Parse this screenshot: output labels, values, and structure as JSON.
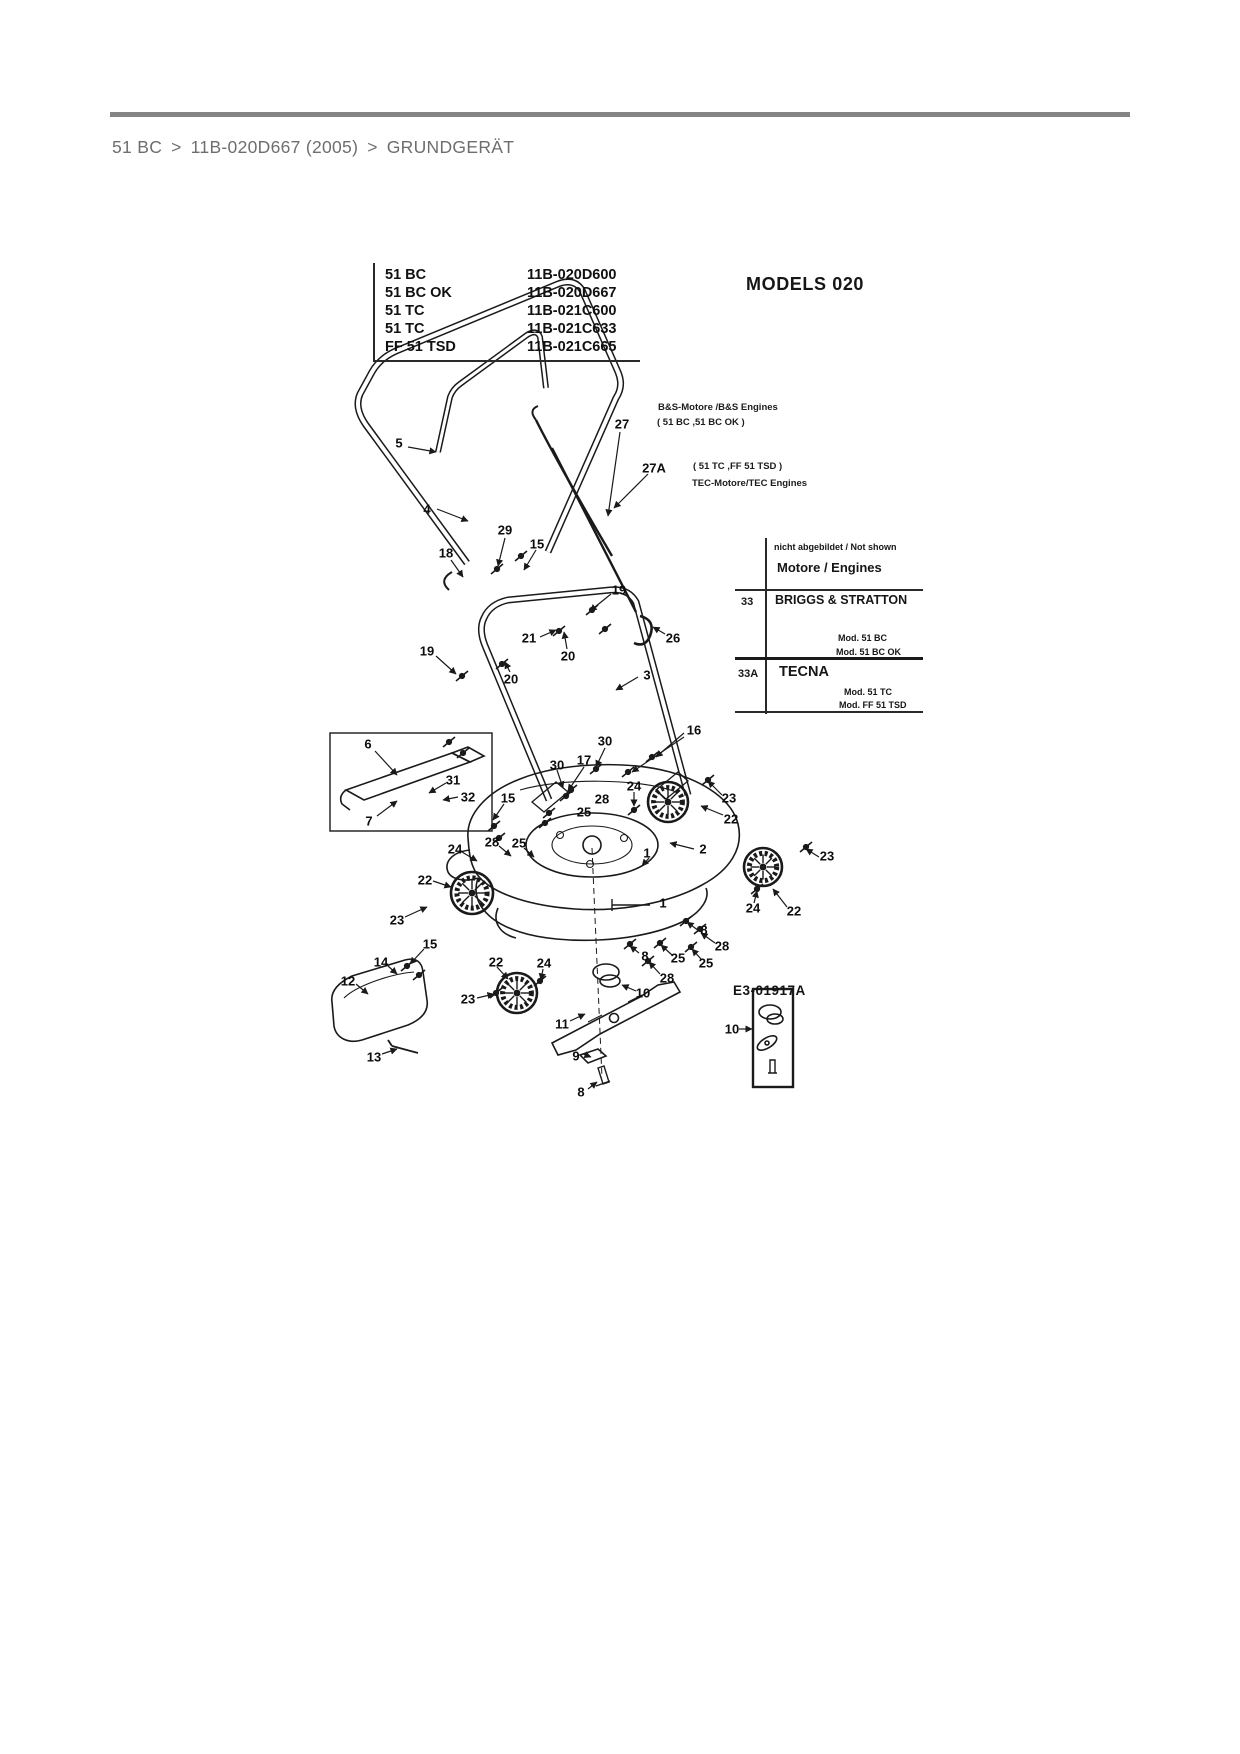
{
  "breadcrumb": {
    "separator": ">",
    "items": [
      {
        "label": "51 BC"
      },
      {
        "label": "11B-020D667 (2005)"
      },
      {
        "label": "GRUNDGERÄT"
      }
    ]
  },
  "models_table": {
    "rows": [
      {
        "name": "51 BC",
        "number": "11B-020D600"
      },
      {
        "name": "51 BC OK",
        "number": "11B-020D667"
      },
      {
        "name": "51 TC",
        "number": "11B-021C600"
      },
      {
        "name": "51 TC",
        "number": "11B-021C633"
      },
      {
        "name": "FF 51 TSD",
        "number": "11B-021C665"
      }
    ]
  },
  "diagram": {
    "title": "MODELS 020",
    "drawing_number": "E3-01917A",
    "engine_notes": {
      "bs_line1": "B&S-Motore /B&S Engines",
      "bs_line2": "( 51 BC ,51 BC OK )",
      "tec_line1": "( 51 TC ,FF 51 TSD )",
      "tec_line2": "TEC-Motore/TEC Engines"
    },
    "engines_table": {
      "not_shown": "nicht abgebildet / Not shown",
      "header": "Motore / Engines",
      "rows": [
        {
          "ref": "33",
          "name": "BRIGGS & STRATTON",
          "models": [
            "Mod. 51 BC",
            "Mod. 51 BC OK"
          ]
        },
        {
          "ref": "33A",
          "name": "TECNA",
          "models": [
            "Mod. 51 TC",
            "Mod. FF 51 TSD"
          ]
        }
      ]
    },
    "part_labels": [
      {
        "t": "5",
        "x": 399,
        "y": 443
      },
      {
        "t": "4",
        "x": 427,
        "y": 509
      },
      {
        "t": "29",
        "x": 505,
        "y": 530
      },
      {
        "t": "15",
        "x": 537,
        "y": 544
      },
      {
        "t": "18",
        "x": 446,
        "y": 553
      },
      {
        "t": "27",
        "x": 622,
        "y": 424
      },
      {
        "t": "27A",
        "x": 654,
        "y": 468
      },
      {
        "t": "19",
        "x": 619,
        "y": 590
      },
      {
        "t": "26",
        "x": 673,
        "y": 638
      },
      {
        "t": "21",
        "x": 529,
        "y": 638
      },
      {
        "t": "20",
        "x": 568,
        "y": 656
      },
      {
        "t": "19",
        "x": 427,
        "y": 651
      },
      {
        "t": "20",
        "x": 511,
        "y": 679
      },
      {
        "t": "3",
        "x": 647,
        "y": 675
      },
      {
        "t": "6",
        "x": 368,
        "y": 744
      },
      {
        "t": "31",
        "x": 453,
        "y": 780
      },
      {
        "t": "32",
        "x": 468,
        "y": 797
      },
      {
        "t": "7",
        "x": 369,
        "y": 821
      },
      {
        "t": "15",
        "x": 508,
        "y": 798
      },
      {
        "t": "30",
        "x": 605,
        "y": 741
      },
      {
        "t": "17",
        "x": 584,
        "y": 760
      },
      {
        "t": "30",
        "x": 557,
        "y": 765
      },
      {
        "t": "16",
        "x": 694,
        "y": 730
      },
      {
        "t": "24",
        "x": 634,
        "y": 786
      },
      {
        "t": "28",
        "x": 602,
        "y": 799
      },
      {
        "t": "25",
        "x": 584,
        "y": 812
      },
      {
        "t": "23",
        "x": 729,
        "y": 798
      },
      {
        "t": "22",
        "x": 731,
        "y": 819
      },
      {
        "t": "28",
        "x": 492,
        "y": 842
      },
      {
        "t": "25",
        "x": 519,
        "y": 843
      },
      {
        "t": "24",
        "x": 455,
        "y": 849
      },
      {
        "t": "22",
        "x": 425,
        "y": 880
      },
      {
        "t": "23",
        "x": 397,
        "y": 920
      },
      {
        "t": "2",
        "x": 703,
        "y": 849
      },
      {
        "t": "1",
        "x": 647,
        "y": 853
      },
      {
        "t": "1",
        "x": 663,
        "y": 903
      },
      {
        "t": "8",
        "x": 704,
        "y": 930
      },
      {
        "t": "28",
        "x": 722,
        "y": 946
      },
      {
        "t": "25",
        "x": 678,
        "y": 958
      },
      {
        "t": "25",
        "x": 706,
        "y": 963
      },
      {
        "t": "28",
        "x": 667,
        "y": 978
      },
      {
        "t": "8",
        "x": 645,
        "y": 956
      },
      {
        "t": "23",
        "x": 827,
        "y": 856
      },
      {
        "t": "22",
        "x": 794,
        "y": 911
      },
      {
        "t": "24",
        "x": 753,
        "y": 908
      },
      {
        "t": "15",
        "x": 430,
        "y": 944
      },
      {
        "t": "14",
        "x": 381,
        "y": 962
      },
      {
        "t": "12",
        "x": 348,
        "y": 981
      },
      {
        "t": "22",
        "x": 496,
        "y": 962
      },
      {
        "t": "24",
        "x": 544,
        "y": 963
      },
      {
        "t": "23",
        "x": 468,
        "y": 999
      },
      {
        "t": "11",
        "x": 562,
        "y": 1024
      },
      {
        "t": "13",
        "x": 374,
        "y": 1057
      },
      {
        "t": "9",
        "x": 576,
        "y": 1056
      },
      {
        "t": "8",
        "x": 581,
        "y": 1092
      },
      {
        "t": "10",
        "x": 643,
        "y": 993
      },
      {
        "t": "10",
        "x": 732,
        "y": 1029
      }
    ]
  }
}
